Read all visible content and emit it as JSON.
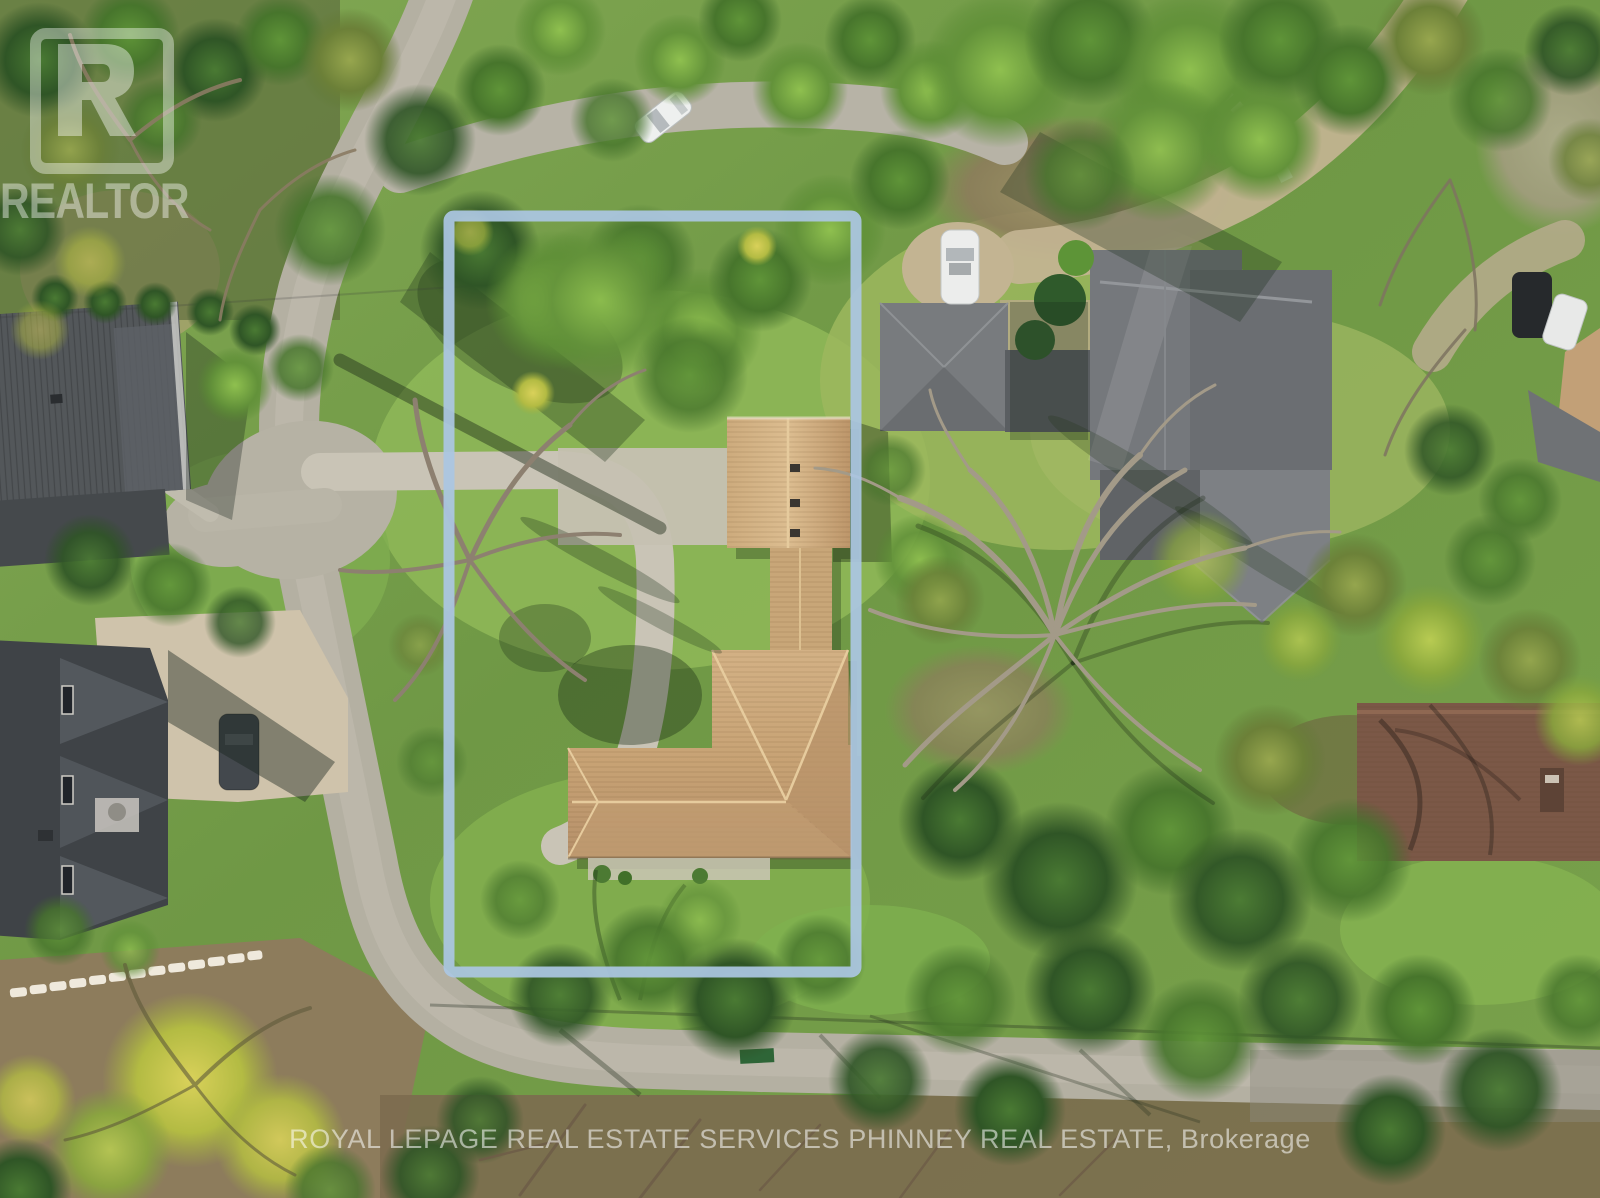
{
  "meta": {
    "kind": "aerial-drone-real-estate-photo",
    "width_px": 1600,
    "height_px": 1198,
    "description": "Overhead springtime aerial view of a treed residential lot outlined in light blue, tan-roof subject house centered, neighboring gray and brown roofs, curving gray road"
  },
  "watermarks": {
    "realtor_logo_word": "REALTOR",
    "brokerage_line": "ROYAL LEPAGE REAL ESTATE SERVICES PHINNEY REAL ESTATE, Brokerage"
  },
  "property_outline": {
    "shape": "rectangle",
    "stroke_hex": "#abc6e2",
    "stroke_width": 11,
    "x": 449,
    "y": 216,
    "width": 407,
    "height": 756
  },
  "palette": {
    "lawn_green": "#7aa04c",
    "canopy_dark_green": "#2c4f23",
    "canopy_bright_green": "#86bb4a",
    "canopy_chartreuse": "#d6cf56",
    "road_gray": "#b4b0a2",
    "driveway_concrete": "#c9c4b6",
    "subject_roof_tan": "#c9a678",
    "neighbor_roof_gray": "#75787c",
    "neighbor_roof_charcoal": "#3f4347",
    "neighbor_roof_brown": "#7b5847",
    "bare_branches": "#9a9181",
    "dirt_brown": "#8d7c5c"
  },
  "scene": {
    "subject_house": "tan shingled T-shaped roof inside blue outline",
    "vehicles": [
      "white car on top road",
      "white car in right driveway",
      "dark car on left paver driveway",
      "dark SUV and white car top-right corner"
    ],
    "landmarks": [
      "large leafless tree right of lot",
      "yellow chartreuse tree bottom-left",
      "white stone retaining wall bottom-left",
      "curving concrete driveway in lot"
    ]
  }
}
